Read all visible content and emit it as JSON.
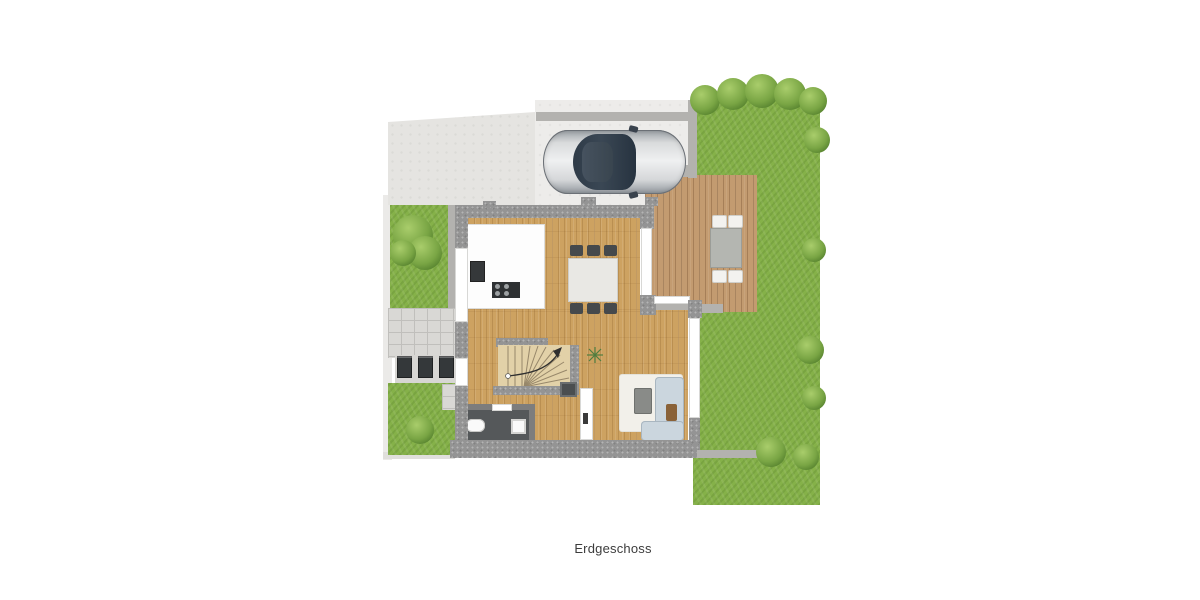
{
  "title": {
    "floor_label": "Erdgeschoss"
  },
  "colors": {
    "grass": "#85b149",
    "bush-hi": "#a9cd6b",
    "bush-mid": "#79a544",
    "bush-lo": "#55812e",
    "wall": "#949494",
    "driveway": "#e5e4e1",
    "carport": "#edecea",
    "wood": "#cda261",
    "deck": "#c39b70",
    "kitchen-white": "#fdfdfd",
    "appliance-dark": "#35383a",
    "table-light": "#e9e8e4",
    "chair-dark": "#45494c",
    "stair-floor": "#e2d1a8",
    "wc-floor": "#55585a",
    "rug": "#f2f0ea",
    "sofa": "#cbd6de",
    "coffee-table": "#898b88",
    "tile": "#d9d8d5",
    "bin": "#34383a",
    "terrace-table": "#b4b6b1",
    "terrace-chair": "#f3f2ef",
    "car-glass": "#333f4c",
    "label": "#3c3c3c"
  }
}
